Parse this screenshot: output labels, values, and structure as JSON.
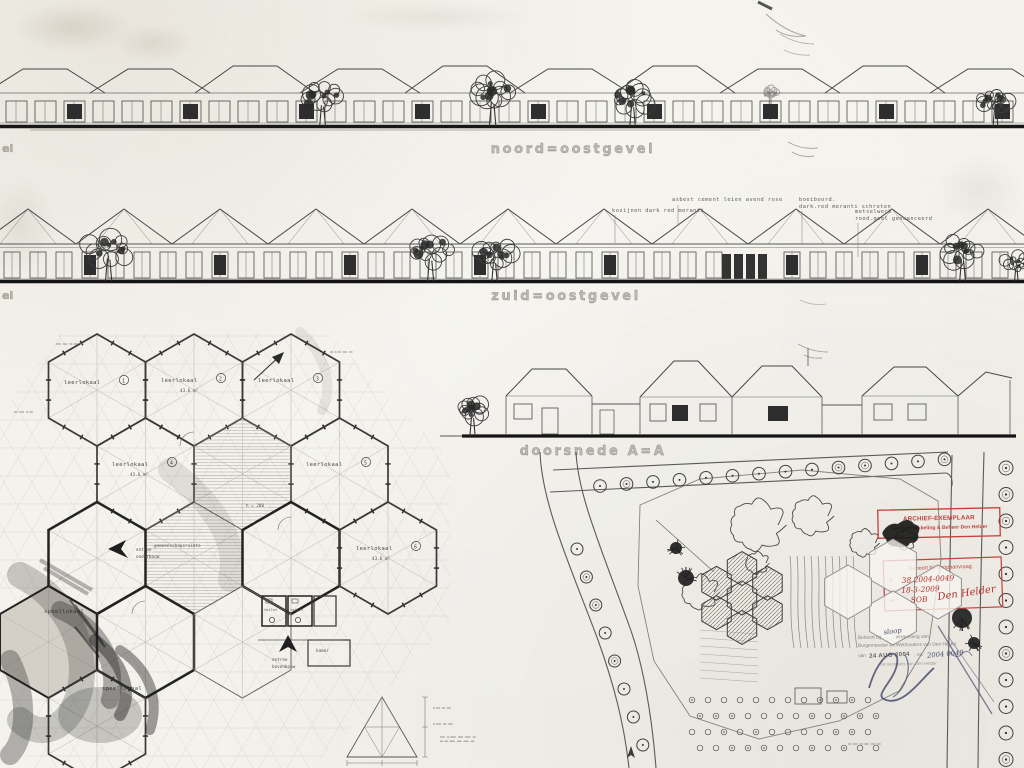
{
  "sheet": {
    "elevation1_label": "noord=oostgevel",
    "elevation2_label": "zuid=oostgevel",
    "section_label": "doorsnede A=A",
    "left_edge_label_1": "el",
    "left_edge_label_2": "el"
  },
  "spec_notes": {
    "windows": "kozijnen dark red meranti",
    "roof": "asbest cement leien avend rose",
    "fascia_1": "boeiboord.",
    "fascia_2": "dark.red meranti schroten",
    "masonry_1": "metselwerk",
    "masonry_2": "rood.geel genuanceerd"
  },
  "floor_plan": {
    "classroom_label": "leerlokaal",
    "classroom_numbers": [
      "1",
      "2",
      "3",
      "4",
      "5",
      "6"
    ],
    "classroom_area": "43.6 m²",
    "common_room_label": "gemeenschapsruimte",
    "play_room_label": "speellokaal",
    "toilet_label": "toilet",
    "room_label_kamer": "kamer",
    "entrance_1_line1": "entree",
    "entrance_1_line2": "onderbouw",
    "entrance_2_line1": "entree",
    "entrance_2_line2": "bovenbouw",
    "height_note": "h = 280"
  },
  "stamps": {
    "archive": {
      "line1": "ARCHIEF-EXEMPLAAR",
      "line2": "Stadsontwikkeling & Beheer Den Helder"
    },
    "demolition_request": {
      "title": "Behoort bij sloopaanvraag",
      "nr_label": "nr.",
      "nr_value": "38  2004-0049",
      "date_label": "d.d.",
      "date_value": "18-3-2009",
      "by_label": "van",
      "by_value": "SOB",
      "by_value2": "Den Helder"
    },
    "permit": {
      "line1_a": "Behoort bij",
      "line1_insert": "sloop",
      "line1_b": "vergunning van",
      "line2": "Burgemeester en Wethouders van Den Helder",
      "line3_a": "van",
      "line3_date": "24 AUG 2004",
      "line3_b": ", no.",
      "line3_no": "2004 0049",
      "line4": "De secretaris van Den Helder"
    }
  }
}
